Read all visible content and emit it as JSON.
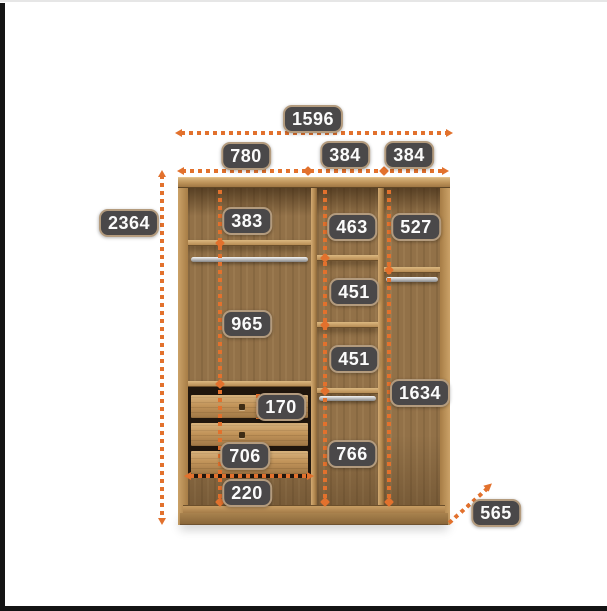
{
  "meta": {
    "type": "furniture-dimension-diagram",
    "subject": "three-section wardrobe interior with shelves, hanging rods and drawers"
  },
  "colors": {
    "accent_orange": "#e2712d",
    "badge_background": "#4a4849",
    "badge_text": "#fbfbfb",
    "wood_light": "#cba268",
    "wood_dark": "#8d6c41"
  },
  "measurements": {
    "total_width": "1596",
    "left_section_width": "780",
    "middle_section_width": "384",
    "right_section_width": "384",
    "overall_height": "2364",
    "left_top_compartment_height": "383",
    "middle_top_compartment_height": "463",
    "right_top_compartment_height": "527",
    "left_hanging_height": "965",
    "middle_compartment_height_1": "451",
    "middle_compartment_height_2": "451",
    "right_hanging_height": "1634",
    "drawer_height": "170",
    "drawer_unit_width": "706",
    "middle_bottom_height": "766",
    "left_bottom_space_height": "220",
    "depth": "565"
  }
}
